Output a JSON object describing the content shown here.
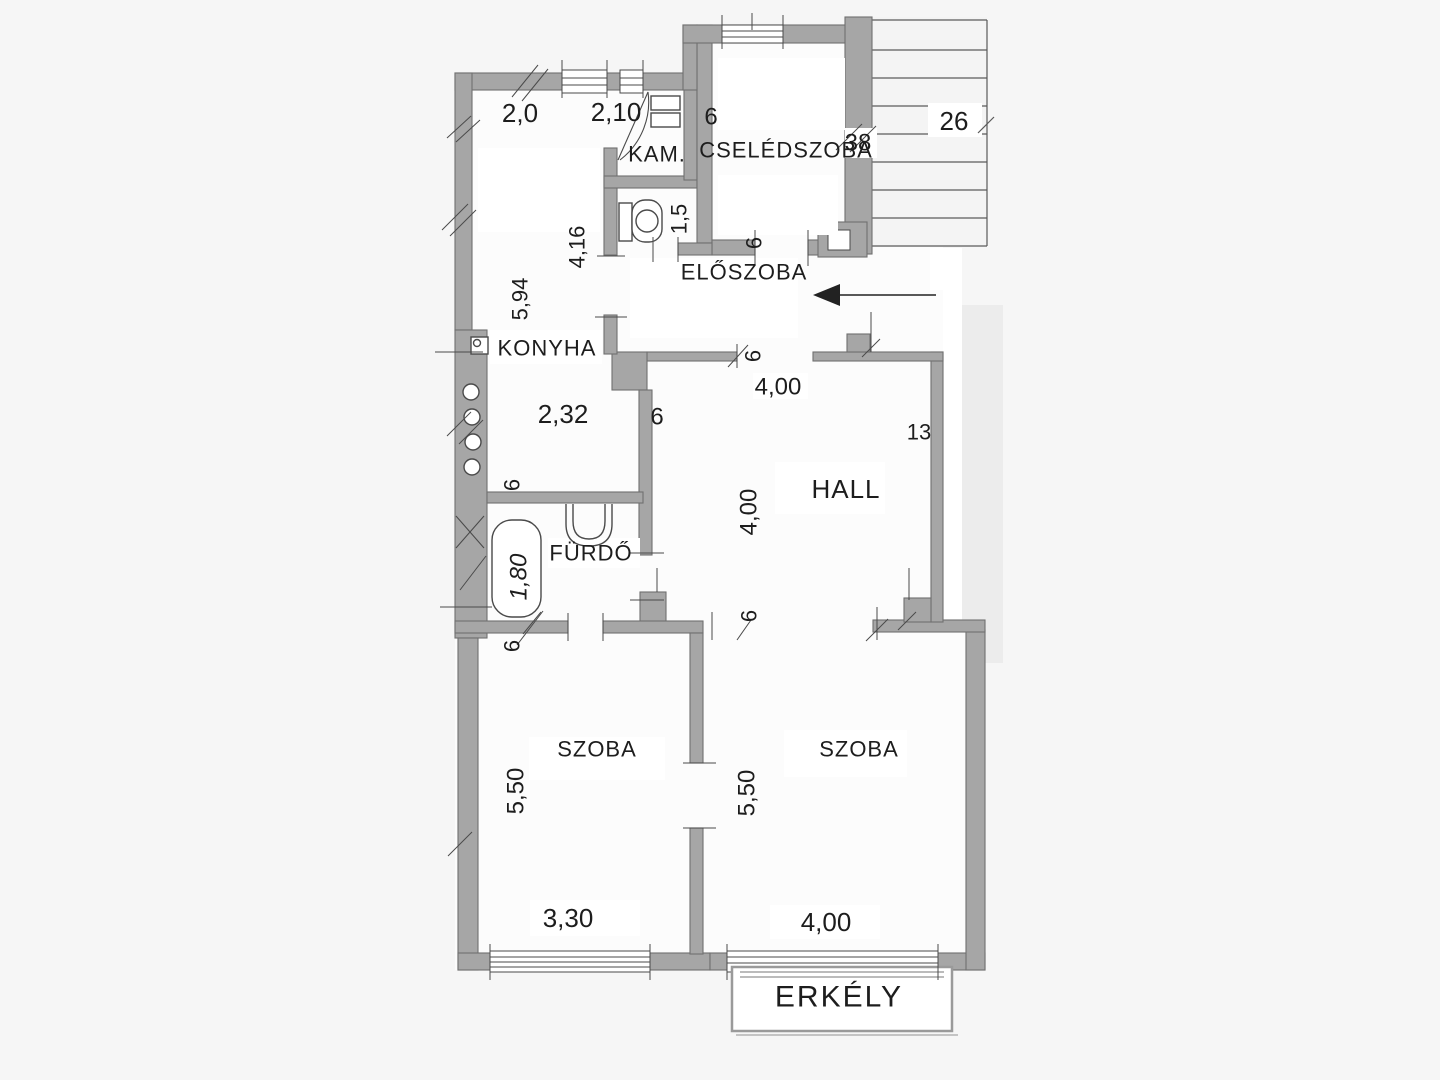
{
  "plan": {
    "title": "apartment-floor-plan",
    "rooms": [
      {
        "label": "KAM."
      },
      {
        "label": "CSELÉDSZOBA"
      },
      {
        "label": "ELŐSZOBA"
      },
      {
        "label": "KONYHA"
      },
      {
        "label": "HALL"
      },
      {
        "label": "FÜRDŐ"
      },
      {
        "label": "SZOBA"
      },
      {
        "label": "SZOBA"
      },
      {
        "label": "ERKÉLY"
      }
    ],
    "dims": [
      "2,0",
      "2,10",
      "6",
      "38",
      "26",
      "1,5",
      "4,16",
      "5,94",
      "2,32",
      "6",
      "6",
      "6",
      "4,00",
      "13",
      "4,00",
      "1,80",
      "6",
      "6",
      "6",
      "5,50",
      "5,50",
      "3,30",
      "4,00"
    ],
    "colors": {
      "wall": "#a6a6a6",
      "wall_outline": "#707070",
      "thin_line": "#4a4a4a",
      "text": "#1d1d1d",
      "background": "#f6f6f6",
      "room_fill": "#fcfcfc",
      "side_band": "#ececec"
    }
  }
}
